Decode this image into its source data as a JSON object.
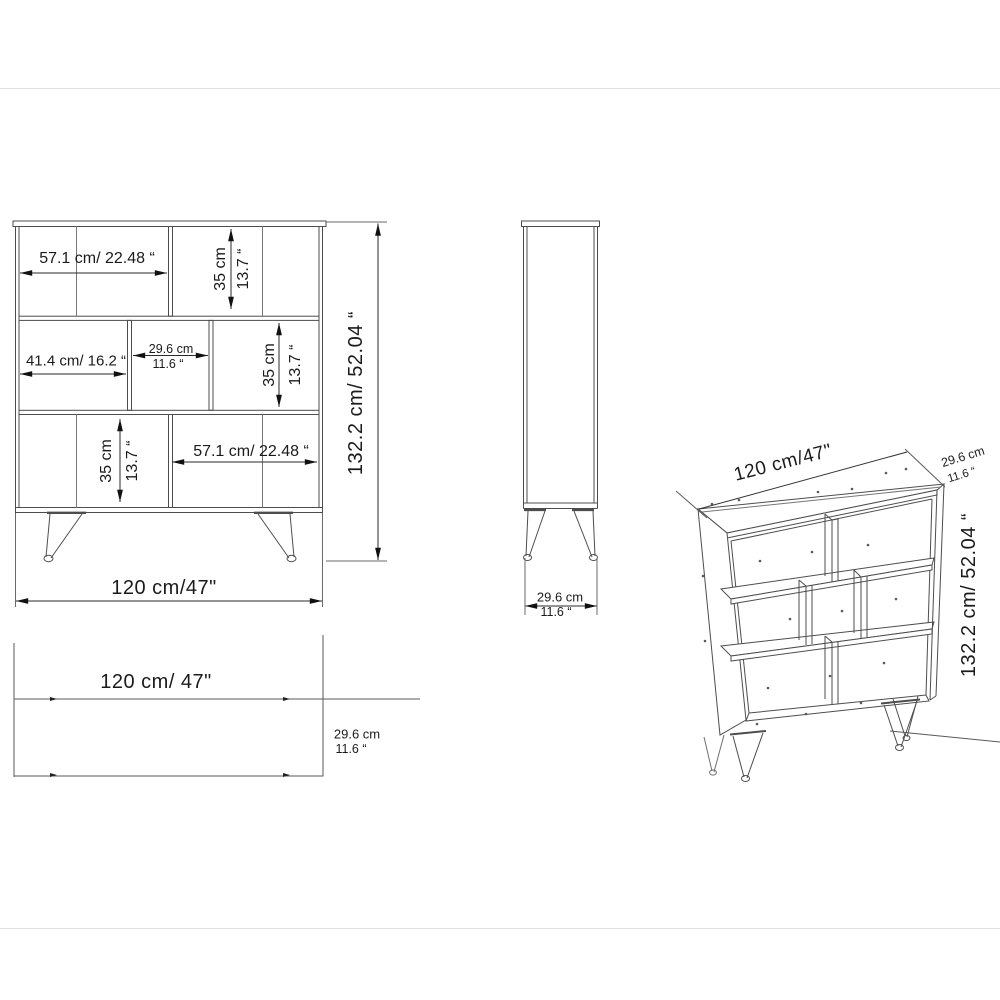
{
  "page": {
    "background": "#ffffff",
    "rule_color": "#e0e0e0",
    "furniture_line_color": "#4d4d4d",
    "dimension_line_color": "#1a1a1a",
    "text_color": "#1b1b1b"
  },
  "front_view": {
    "shelf_width_top": "57.1 cm/ 22.48 “",
    "cell_height_top_cm": "35 cm",
    "cell_height_top_in": "13.7 “",
    "middle_left_width": "41.4 cm/ 16.2 “",
    "middle_cell_width_cm": "29.6 cm",
    "middle_cell_width_in": "11.6 “",
    "middle_right_height_cm": "35 cm",
    "middle_right_height_in": "13.7 “",
    "bottom_cell_height_cm": "35 cm",
    "bottom_cell_height_in": "13.7 “",
    "shelf_width_bottom": "57.1 cm/ 22.48 “",
    "overall_height": "132.2 cm/ 52.04 “",
    "overall_width": "120 cm/47\""
  },
  "side_view": {
    "depth_cm": "29.6 cm",
    "depth_in": "11.6 “"
  },
  "top_view": {
    "width": "120 cm/ 47\"",
    "depth_cm": "29.6 cm",
    "depth_in": "11.6 “"
  },
  "iso_view": {
    "width": "120 cm/47\"",
    "depth_cm": "29.6 cm",
    "depth_in": "11.6 “",
    "height": "132.2 cm/ 52.04 “"
  }
}
